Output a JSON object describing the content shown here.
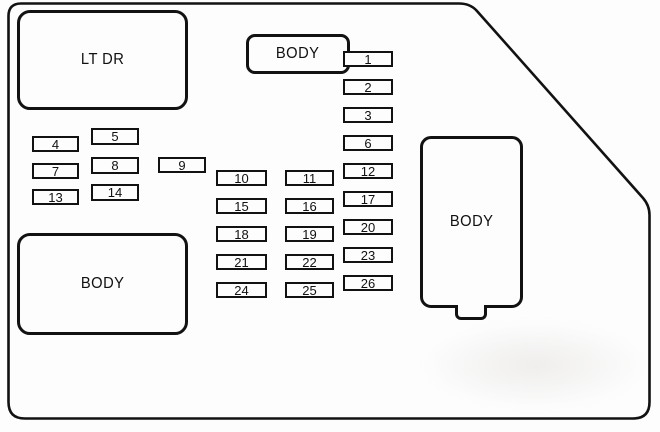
{
  "diagram": {
    "kind": "fuse-box-diagram",
    "colors": {
      "line": "#121212",
      "background": "#fdfdfd"
    },
    "blocks": [
      {
        "id": "lt-dr",
        "label": "LT DR"
      },
      {
        "id": "body-top",
        "label": "BODY"
      },
      {
        "id": "body-left",
        "label": "BODY"
      },
      {
        "id": "body-right",
        "label": "BODY"
      }
    ],
    "fuse_groups": {
      "left_col_a": [
        "4",
        "7",
        "13"
      ],
      "left_col_b": [
        "5",
        "8",
        "14"
      ],
      "left_standalone": [
        "9"
      ],
      "mid_left_column": [
        "10",
        "15",
        "18",
        "21",
        "24"
      ],
      "mid_right_column": [
        "11",
        "16",
        "19",
        "22",
        "25"
      ],
      "right_column": [
        "1",
        "2",
        "3",
        "6",
        "12",
        "17",
        "20",
        "23",
        "26"
      ]
    }
  }
}
